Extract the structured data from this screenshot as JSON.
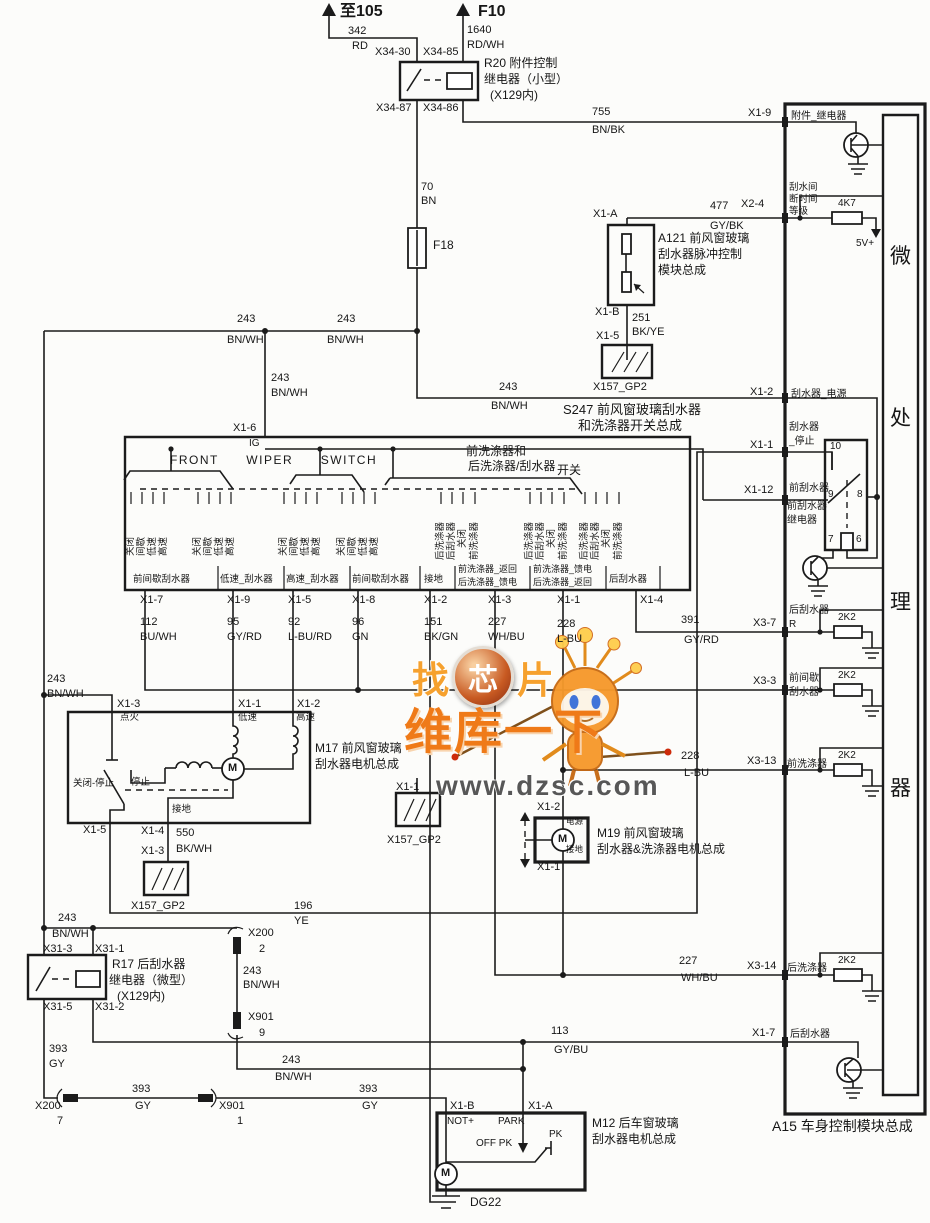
{
  "watermark": {
    "w1a": "找",
    "w1b": "芯",
    "w1c": "片",
    "w2": "维库一下",
    "w3": "www.dzsc.com"
  },
  "labels": [
    {
      "t": "至105",
      "x": 340,
      "y": 3,
      "c": "t16"
    },
    {
      "t": "F10",
      "x": 478,
      "y": 3,
      "c": "t16"
    },
    {
      "t": "342",
      "x": 348,
      "y": 25
    },
    {
      "t": "RD",
      "x": 352,
      "y": 40
    },
    {
      "t": "1640",
      "x": 467,
      "y": 24
    },
    {
      "t": "RD/WH",
      "x": 467,
      "y": 39
    },
    {
      "t": "X34-30",
      "x": 375,
      "y": 46
    },
    {
      "t": "X34-85",
      "x": 423,
      "y": 46
    },
    {
      "t": "X34-87",
      "x": 376,
      "y": 102
    },
    {
      "t": "X34-86",
      "x": 423,
      "y": 102
    },
    {
      "t": "R20 附件控制",
      "x": 484,
      "y": 57,
      "c": "t12"
    },
    {
      "t": "继电器（小型）",
      "x": 484,
      "y": 73,
      "c": "t12"
    },
    {
      "t": "(X129内)",
      "x": 490,
      "y": 89,
      "c": "t12"
    },
    {
      "t": "755",
      "x": 592,
      "y": 106
    },
    {
      "t": "BN/BK",
      "x": 592,
      "y": 124
    },
    {
      "t": "X1-9",
      "x": 748,
      "y": 107
    },
    {
      "t": "附件_继电器",
      "x": 791,
      "y": 111,
      "c": "t10"
    },
    {
      "t": "70",
      "x": 421,
      "y": 181
    },
    {
      "t": "BN",
      "x": 421,
      "y": 195
    },
    {
      "t": "F18",
      "x": 433,
      "y": 239,
      "c": "t12"
    },
    {
      "t": "477",
      "x": 710,
      "y": 200
    },
    {
      "t": "GY/BK",
      "x": 710,
      "y": 220
    },
    {
      "t": "X2-4",
      "x": 741,
      "y": 198
    },
    {
      "t": "刮水间",
      "x": 789,
      "y": 183,
      "c": "t95"
    },
    {
      "t": "断时间",
      "x": 789,
      "y": 195,
      "c": "t95"
    },
    {
      "t": "等级",
      "x": 789,
      "y": 207,
      "c": "t95"
    },
    {
      "t": "4K7",
      "x": 838,
      "y": 198,
      "c": "t10"
    },
    {
      "t": "5V+",
      "x": 856,
      "y": 238,
      "c": "t10"
    },
    {
      "t": "A121 前风窗玻璃",
      "x": 658,
      "y": 232,
      "c": "t12"
    },
    {
      "t": "刮水器脉冲控制",
      "x": 658,
      "y": 248,
      "c": "t12"
    },
    {
      "t": "模块总成",
      "x": 658,
      "y": 264,
      "c": "t12"
    },
    {
      "t": "X1-A",
      "x": 593,
      "y": 208
    },
    {
      "t": "X1-B",
      "x": 595,
      "y": 306
    },
    {
      "t": "251",
      "x": 632,
      "y": 312
    },
    {
      "t": "BK/YE",
      "x": 632,
      "y": 326
    },
    {
      "t": "X1-5",
      "x": 596,
      "y": 330
    },
    {
      "t": "X157_GP2",
      "x": 593,
      "y": 381
    },
    {
      "t": "微",
      "x": 890,
      "y": 245,
      "c": "t22"
    },
    {
      "t": "处",
      "x": 890,
      "y": 407,
      "c": "t22"
    },
    {
      "t": "理",
      "x": 890,
      "y": 591,
      "c": "t22"
    },
    {
      "t": "器",
      "x": 890,
      "y": 777,
      "c": "t22"
    },
    {
      "t": "243",
      "x": 237,
      "y": 313
    },
    {
      "t": "BN/WH",
      "x": 227,
      "y": 334
    },
    {
      "t": "243",
      "x": 337,
      "y": 313
    },
    {
      "t": "BN/WH",
      "x": 327,
      "y": 334
    },
    {
      "t": "243",
      "x": 271,
      "y": 372
    },
    {
      "t": "BN/WH",
      "x": 271,
      "y": 387
    },
    {
      "t": "243",
      "x": 499,
      "y": 381
    },
    {
      "t": "BN/WH",
      "x": 491,
      "y": 400
    },
    {
      "t": "X1-2",
      "x": 750,
      "y": 386
    },
    {
      "t": "刮水器_电源",
      "x": 791,
      "y": 389,
      "c": "t10"
    },
    {
      "t": "S247 前风窗玻璃刮水器",
      "x": 563,
      "y": 403,
      "c": "t13"
    },
    {
      "t": "和洗涤器开关总成",
      "x": 578,
      "y": 419,
      "c": "t13"
    },
    {
      "t": "X1-1",
      "x": 750,
      "y": 439
    },
    {
      "t": "刮水器",
      "x": 789,
      "y": 422,
      "c": "t10"
    },
    {
      "t": "_停止",
      "x": 789,
      "y": 436,
      "c": "t10"
    },
    {
      "t": "10",
      "x": 830,
      "y": 441,
      "c": "t10"
    },
    {
      "t": "X1-12",
      "x": 744,
      "y": 484
    },
    {
      "t": "前刮水器",
      "x": 789,
      "y": 483,
      "c": "t10"
    },
    {
      "t": "9",
      "x": 828,
      "y": 489,
      "c": "t10"
    },
    {
      "t": "8",
      "x": 857,
      "y": 489,
      "c": "t10"
    },
    {
      "t": "前刮水器",
      "x": 787,
      "y": 501,
      "c": "t10"
    },
    {
      "t": "继电器",
      "x": 787,
      "y": 515,
      "c": "t10"
    },
    {
      "t": "7",
      "x": 828,
      "y": 534,
      "c": "t10"
    },
    {
      "t": "6",
      "x": 856,
      "y": 534,
      "c": "t10"
    },
    {
      "t": "X1-6",
      "x": 233,
      "y": 422
    },
    {
      "t": "IG",
      "x": 249,
      "y": 438,
      "c": "t10"
    },
    {
      "t": "FRONT  WIPER  SWITCH",
      "x": 170,
      "y": 454,
      "c": "t12 ws"
    },
    {
      "t": "前洗涤器和",
      "x": 466,
      "y": 445,
      "c": "t12"
    },
    {
      "t": "后洗涤器/刮水器",
      "x": 468,
      "y": 460,
      "c": "t12"
    },
    {
      "t": "开关",
      "x": 557,
      "y": 464,
      "c": "t12"
    },
    {
      "t": "前间歇刮水器",
      "x": 133,
      "y": 575,
      "c": "t95"
    },
    {
      "t": "低速_刮水器",
      "x": 220,
      "y": 575,
      "c": "t95"
    },
    {
      "t": "高速_刮水器",
      "x": 286,
      "y": 575,
      "c": "t95"
    },
    {
      "t": "前间歇刮水器",
      "x": 352,
      "y": 575,
      "c": "t95"
    },
    {
      "t": "接地",
      "x": 424,
      "y": 575,
      "c": "t95"
    },
    {
      "t": "前洗涤器_返回",
      "x": 458,
      "y": 564,
      "c": "t9"
    },
    {
      "t": "后洗涤器_馈电",
      "x": 458,
      "y": 577,
      "c": "t9"
    },
    {
      "t": "前洗涤器_馈电",
      "x": 533,
      "y": 564,
      "c": "t9"
    },
    {
      "t": "后洗涤器_返回",
      "x": 533,
      "y": 577,
      "c": "t9"
    },
    {
      "t": "后刮水器",
      "x": 609,
      "y": 575,
      "c": "t95"
    },
    {
      "t": "X1-7",
      "x": 140,
      "y": 594
    },
    {
      "t": "X1-9",
      "x": 227,
      "y": 594
    },
    {
      "t": "X1-5",
      "x": 288,
      "y": 594
    },
    {
      "t": "X1-8",
      "x": 352,
      "y": 594
    },
    {
      "t": "X1-2",
      "x": 424,
      "y": 594
    },
    {
      "t": "X1-3",
      "x": 488,
      "y": 594
    },
    {
      "t": "X1-1",
      "x": 557,
      "y": 594
    },
    {
      "t": "X1-4",
      "x": 640,
      "y": 594
    },
    {
      "t": "112",
      "x": 140,
      "y": 616
    },
    {
      "t": "BU/WH",
      "x": 140,
      "y": 631
    },
    {
      "t": "95",
      "x": 227,
      "y": 616
    },
    {
      "t": "GY/RD",
      "x": 227,
      "y": 631
    },
    {
      "t": "92",
      "x": 288,
      "y": 616
    },
    {
      "t": "L-BU/RD",
      "x": 288,
      "y": 631
    },
    {
      "t": "96",
      "x": 352,
      "y": 616
    },
    {
      "t": "GN",
      "x": 352,
      "y": 631
    },
    {
      "t": "151",
      "x": 424,
      "y": 616
    },
    {
      "t": "BK/GN",
      "x": 424,
      "y": 631
    },
    {
      "t": "227",
      "x": 488,
      "y": 616
    },
    {
      "t": "WH/BU",
      "x": 488,
      "y": 631
    },
    {
      "t": "228",
      "x": 557,
      "y": 618
    },
    {
      "t": "L-BU",
      "x": 557,
      "y": 633
    },
    {
      "t": "391",
      "x": 681,
      "y": 614
    },
    {
      "t": "GY/RD",
      "x": 684,
      "y": 634
    },
    {
      "t": "X3-7",
      "x": 753,
      "y": 617
    },
    {
      "t": "后刮水器",
      "x": 789,
      "y": 605,
      "c": "t10"
    },
    {
      "t": "R",
      "x": 789,
      "y": 619,
      "c": "t10"
    },
    {
      "t": "2K2",
      "x": 838,
      "y": 612,
      "c": "t10"
    },
    {
      "t": "X3-3",
      "x": 753,
      "y": 675
    },
    {
      "t": "前间歇",
      "x": 789,
      "y": 673,
      "c": "t10"
    },
    {
      "t": "刮水器",
      "x": 789,
      "y": 687,
      "c": "t10"
    },
    {
      "t": "2K2",
      "x": 838,
      "y": 670,
      "c": "t10"
    },
    {
      "t": "X3-13",
      "x": 747,
      "y": 755
    },
    {
      "t": "前洗涤器",
      "x": 787,
      "y": 759,
      "c": "t10"
    },
    {
      "t": "2K2",
      "x": 838,
      "y": 750,
      "c": "t10"
    },
    {
      "t": "228",
      "x": 681,
      "y": 750
    },
    {
      "t": "L-BU",
      "x": 684,
      "y": 767
    },
    {
      "t": "X3-14",
      "x": 747,
      "y": 960
    },
    {
      "t": "后洗涤器",
      "x": 787,
      "y": 963,
      "c": "t10"
    },
    {
      "t": "2K2",
      "x": 838,
      "y": 955,
      "c": "t10"
    },
    {
      "t": "227",
      "x": 679,
      "y": 955
    },
    {
      "t": "WH/BU",
      "x": 681,
      "y": 972
    },
    {
      "t": "X1-7",
      "x": 752,
      "y": 1027
    },
    {
      "t": "后刮水器",
      "x": 790,
      "y": 1029,
      "c": "t10"
    },
    {
      "t": "A15 车身控制模块总成",
      "x": 772,
      "y": 1119,
      "c": "t14"
    },
    {
      "t": "243",
      "x": 47,
      "y": 673
    },
    {
      "t": "BN/WH",
      "x": 47,
      "y": 688
    },
    {
      "t": "X1-3",
      "x": 117,
      "y": 698
    },
    {
      "t": "点火",
      "x": 120,
      "y": 713,
      "c": "t95"
    },
    {
      "t": "X1-1",
      "x": 238,
      "y": 698
    },
    {
      "t": "低速",
      "x": 238,
      "y": 713,
      "c": "t95"
    },
    {
      "t": "X1-2",
      "x": 297,
      "y": 698
    },
    {
      "t": "高速",
      "x": 296,
      "y": 713,
      "c": "t95"
    },
    {
      "t": "M17 前风窗玻璃",
      "x": 315,
      "y": 742,
      "c": "t12"
    },
    {
      "t": "刮水器电机总成",
      "x": 315,
      "y": 758,
      "c": "t12"
    },
    {
      "t": "关闭-停止",
      "x": 73,
      "y": 779,
      "c": "t95"
    },
    {
      "t": "停止",
      "x": 131,
      "y": 778,
      "c": "t95"
    },
    {
      "t": "接地",
      "x": 172,
      "y": 805,
      "c": "t95"
    },
    {
      "t": "X1-5",
      "x": 83,
      "y": 824
    },
    {
      "t": "X1-4",
      "x": 141,
      "y": 825
    },
    {
      "t": "550",
      "x": 176,
      "y": 827
    },
    {
      "t": "X1-3",
      "x": 141,
      "y": 845
    },
    {
      "t": "BK/WH",
      "x": 176,
      "y": 843
    },
    {
      "t": "X157_GP2",
      "x": 131,
      "y": 900
    },
    {
      "t": "X1-1",
      "x": 396,
      "y": 781
    },
    {
      "t": "X157_GP2",
      "x": 387,
      "y": 834
    },
    {
      "t": "196",
      "x": 294,
      "y": 900
    },
    {
      "t": "YE",
      "x": 294,
      "y": 915
    },
    {
      "t": "X1-2",
      "x": 537,
      "y": 801
    },
    {
      "t": "电源",
      "x": 566,
      "y": 817,
      "c": "t85"
    },
    {
      "t": "接地",
      "x": 566,
      "y": 845,
      "c": "t85"
    },
    {
      "t": "X1-1",
      "x": 537,
      "y": 861
    },
    {
      "t": "M19 前风窗玻璃",
      "x": 597,
      "y": 827,
      "c": "t12"
    },
    {
      "t": "刮水器&洗涤器电机总成",
      "x": 597,
      "y": 843,
      "c": "t12"
    },
    {
      "t": "243",
      "x": 58,
      "y": 912
    },
    {
      "t": "BN/WH",
      "x": 52,
      "y": 928
    },
    {
      "t": "X31-3",
      "x": 43,
      "y": 943
    },
    {
      "t": "X31-1",
      "x": 95,
      "y": 943
    },
    {
      "t": "R17 后刮水器",
      "x": 112,
      "y": 958,
      "c": "t12"
    },
    {
      "t": "继电器（微型）",
      "x": 109,
      "y": 974,
      "c": "t12"
    },
    {
      "t": "(X129内)",
      "x": 117,
      "y": 990,
      "c": "t12"
    },
    {
      "t": "X31-5",
      "x": 43,
      "y": 1001
    },
    {
      "t": "X31-2",
      "x": 95,
      "y": 1001
    },
    {
      "t": "X200",
      "x": 248,
      "y": 927
    },
    {
      "t": "2",
      "x": 259,
      "y": 943
    },
    {
      "t": "243",
      "x": 243,
      "y": 965
    },
    {
      "t": "BN/WH",
      "x": 243,
      "y": 979
    },
    {
      "t": "X901",
      "x": 248,
      "y": 1011
    },
    {
      "t": "9",
      "x": 259,
      "y": 1027
    },
    {
      "t": "243",
      "x": 282,
      "y": 1054
    },
    {
      "t": "BN/WH",
      "x": 275,
      "y": 1071
    },
    {
      "t": "393",
      "x": 49,
      "y": 1043
    },
    {
      "t": "GY",
      "x": 49,
      "y": 1058
    },
    {
      "t": "X200",
      "x": 35,
      "y": 1100
    },
    {
      "t": "7",
      "x": 57,
      "y": 1115
    },
    {
      "t": "393",
      "x": 132,
      "y": 1083
    },
    {
      "t": "GY",
      "x": 135,
      "y": 1100
    },
    {
      "t": "X901",
      "x": 219,
      "y": 1100
    },
    {
      "t": "1",
      "x": 237,
      "y": 1115
    },
    {
      "t": "393",
      "x": 359,
      "y": 1083
    },
    {
      "t": "GY",
      "x": 362,
      "y": 1100
    },
    {
      "t": "113",
      "x": 551,
      "y": 1025
    },
    {
      "t": "GY/BU",
      "x": 554,
      "y": 1044
    },
    {
      "t": "X1-B",
      "x": 450,
      "y": 1100
    },
    {
      "t": "X1-A",
      "x": 528,
      "y": 1100
    },
    {
      "t": "NOT+",
      "x": 447,
      "y": 1116,
      "c": "t10"
    },
    {
      "t": "PARK",
      "x": 498,
      "y": 1116,
      "c": "t10"
    },
    {
      "t": "OFF PK",
      "x": 476,
      "y": 1138,
      "c": "t10"
    },
    {
      "t": "PK",
      "x": 549,
      "y": 1129,
      "c": "t10"
    },
    {
      "t": "M12 后车窗玻璃",
      "x": 592,
      "y": 1117,
      "c": "t12"
    },
    {
      "t": "刮水器电机总成",
      "x": 592,
      "y": 1133,
      "c": "t12"
    },
    {
      "t": "DG22",
      "x": 470,
      "y": 1196,
      "c": "t12"
    },
    {
      "t": "M",
      "x": 228,
      "y": 762,
      "c": "mlab"
    },
    {
      "t": "M",
      "x": 558,
      "y": 833,
      "c": "mlab"
    },
    {
      "t": "M",
      "x": 441,
      "y": 1167,
      "c": "mlab"
    }
  ],
  "vlabels": [
    {
      "t": "关闭",
      "x": 131,
      "y": 556
    },
    {
      "t": "间歇",
      "x": 142,
      "y": 556
    },
    {
      "t": "低速",
      "x": 153,
      "y": 556
    },
    {
      "t": "高速",
      "x": 164,
      "y": 556
    },
    {
      "t": "关闭",
      "x": 198,
      "y": 556
    },
    {
      "t": "间歇",
      "x": 209,
      "y": 556
    },
    {
      "t": "低速",
      "x": 220,
      "y": 556
    },
    {
      "t": "高速",
      "x": 231,
      "y": 556
    },
    {
      "t": "关闭",
      "x": 284,
      "y": 556
    },
    {
      "t": "间歇",
      "x": 295,
      "y": 556
    },
    {
      "t": "低速",
      "x": 306,
      "y": 556
    },
    {
      "t": "高速",
      "x": 317,
      "y": 556
    },
    {
      "t": "关闭",
      "x": 342,
      "y": 556
    },
    {
      "t": "间歇",
      "x": 353,
      "y": 556
    },
    {
      "t": "低速",
      "x": 364,
      "y": 556
    },
    {
      "t": "高速",
      "x": 375,
      "y": 556
    },
    {
      "t": "后洗涤器",
      "x": 441,
      "y": 560
    },
    {
      "t": "后刮水器",
      "x": 452,
      "y": 560
    },
    {
      "t": "关闭",
      "x": 463,
      "y": 548
    },
    {
      "t": "前洗涤器",
      "x": 475,
      "y": 560
    },
    {
      "t": "后洗涤器",
      "x": 530,
      "y": 560
    },
    {
      "t": "后刮水器",
      "x": 541,
      "y": 560
    },
    {
      "t": "关闭",
      "x": 552,
      "y": 548
    },
    {
      "t": "前洗涤器",
      "x": 564,
      "y": 560
    },
    {
      "t": "后洗涤器",
      "x": 585,
      "y": 560
    },
    {
      "t": "后刮水器",
      "x": 596,
      "y": 560
    },
    {
      "t": "关闭",
      "x": 607,
      "y": 548
    },
    {
      "t": "前洗涤器",
      "x": 619,
      "y": 560
    }
  ]
}
